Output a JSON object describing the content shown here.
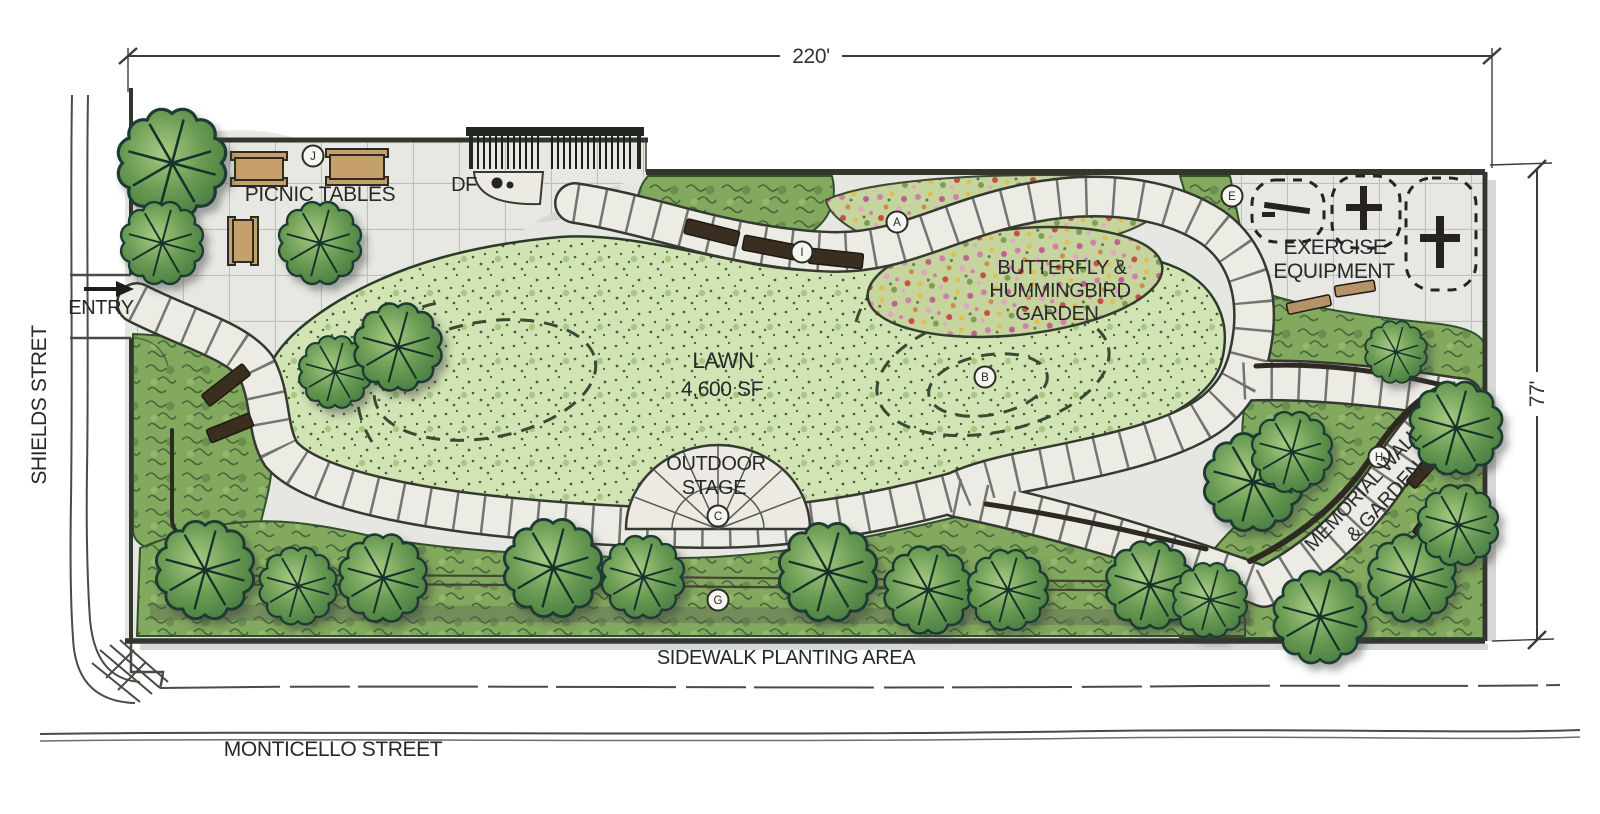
{
  "drawing": {
    "type": "landscape-site-plan"
  },
  "dimensions": {
    "top_width": "220'",
    "right_height": "77'"
  },
  "streets": {
    "left": "SHIELDS STRET",
    "bottom": "MONTICELLO STREET"
  },
  "labels": {
    "entry": "ENTRY",
    "picnic_tables": "PICNIC TABLES",
    "drinking_fountain": "DF",
    "lawn_line1": "LAWN",
    "lawn_line2": "4,600 SF",
    "garden_line1": "BUTTERFLY &",
    "garden_line2": "HUMMINGBIRD",
    "garden_line3": "GARDEN",
    "exercise_line1": "EXERCISE",
    "exercise_line2": "EQUIPMENT",
    "stage_line1": "OUTDOOR",
    "stage_line2": "STAGE",
    "memorial_line1": "MEMORIAL WALL",
    "memorial_line2": "& GARDEN",
    "sidewalk_area": "SIDEWALK PLANTING AREA"
  },
  "markers": {
    "a": "A",
    "b": "B",
    "c": "C",
    "e": "E",
    "g": "G",
    "h": "H",
    "i": "I",
    "j": "J"
  },
  "colors": {
    "lawn": "#d2e4b4",
    "shrub": "#83a95e",
    "flower_bed": "#c6d59e",
    "paving": "#e6e7e2",
    "path": "#ecebe4",
    "ink": "#2e332c",
    "wood": "#c6a06b",
    "tree_dark": "#1c3a31"
  }
}
